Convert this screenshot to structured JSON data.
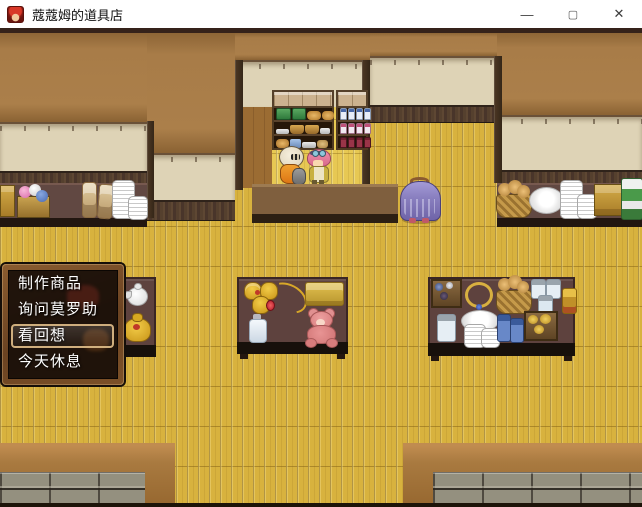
{
  "window": {
    "app_icon": "red-haired-character-face",
    "title": "蔻蔻姆的道具店",
    "controls": {
      "minimize": "—",
      "maximize": "▢",
      "close": "✕"
    }
  },
  "menu": {
    "items": [
      {
        "label": "制作商品"
      },
      {
        "label": "询问莫罗助"
      },
      {
        "label": "看回想"
      },
      {
        "label": "今天休息"
      }
    ],
    "selected_index": 2
  },
  "scene": {
    "sprites": [
      {
        "name": "masked-shopkeeper"
      },
      {
        "name": "pink-haired-customer"
      },
      {
        "name": "purple-hooded-figure"
      }
    ],
    "furniture": [
      "bread-shelf",
      "bottle-shelf",
      "left-counter",
      "shop-counter",
      "right-counter",
      "left-item-table",
      "center-item-table",
      "right-item-table"
    ]
  },
  "colors": {
    "floor": "#d8b23e",
    "wall_brown": "#a87c48",
    "wall_beige": "#ded3b6",
    "trim_dark": "#4c3829",
    "counter_maroon": "#5e4540",
    "menu_frame_wood": "#7a5026",
    "menu_background": "rgba(19,11,7,0.88)",
    "menu_text": "#ffffff",
    "cursor_border": "#d8b684"
  }
}
